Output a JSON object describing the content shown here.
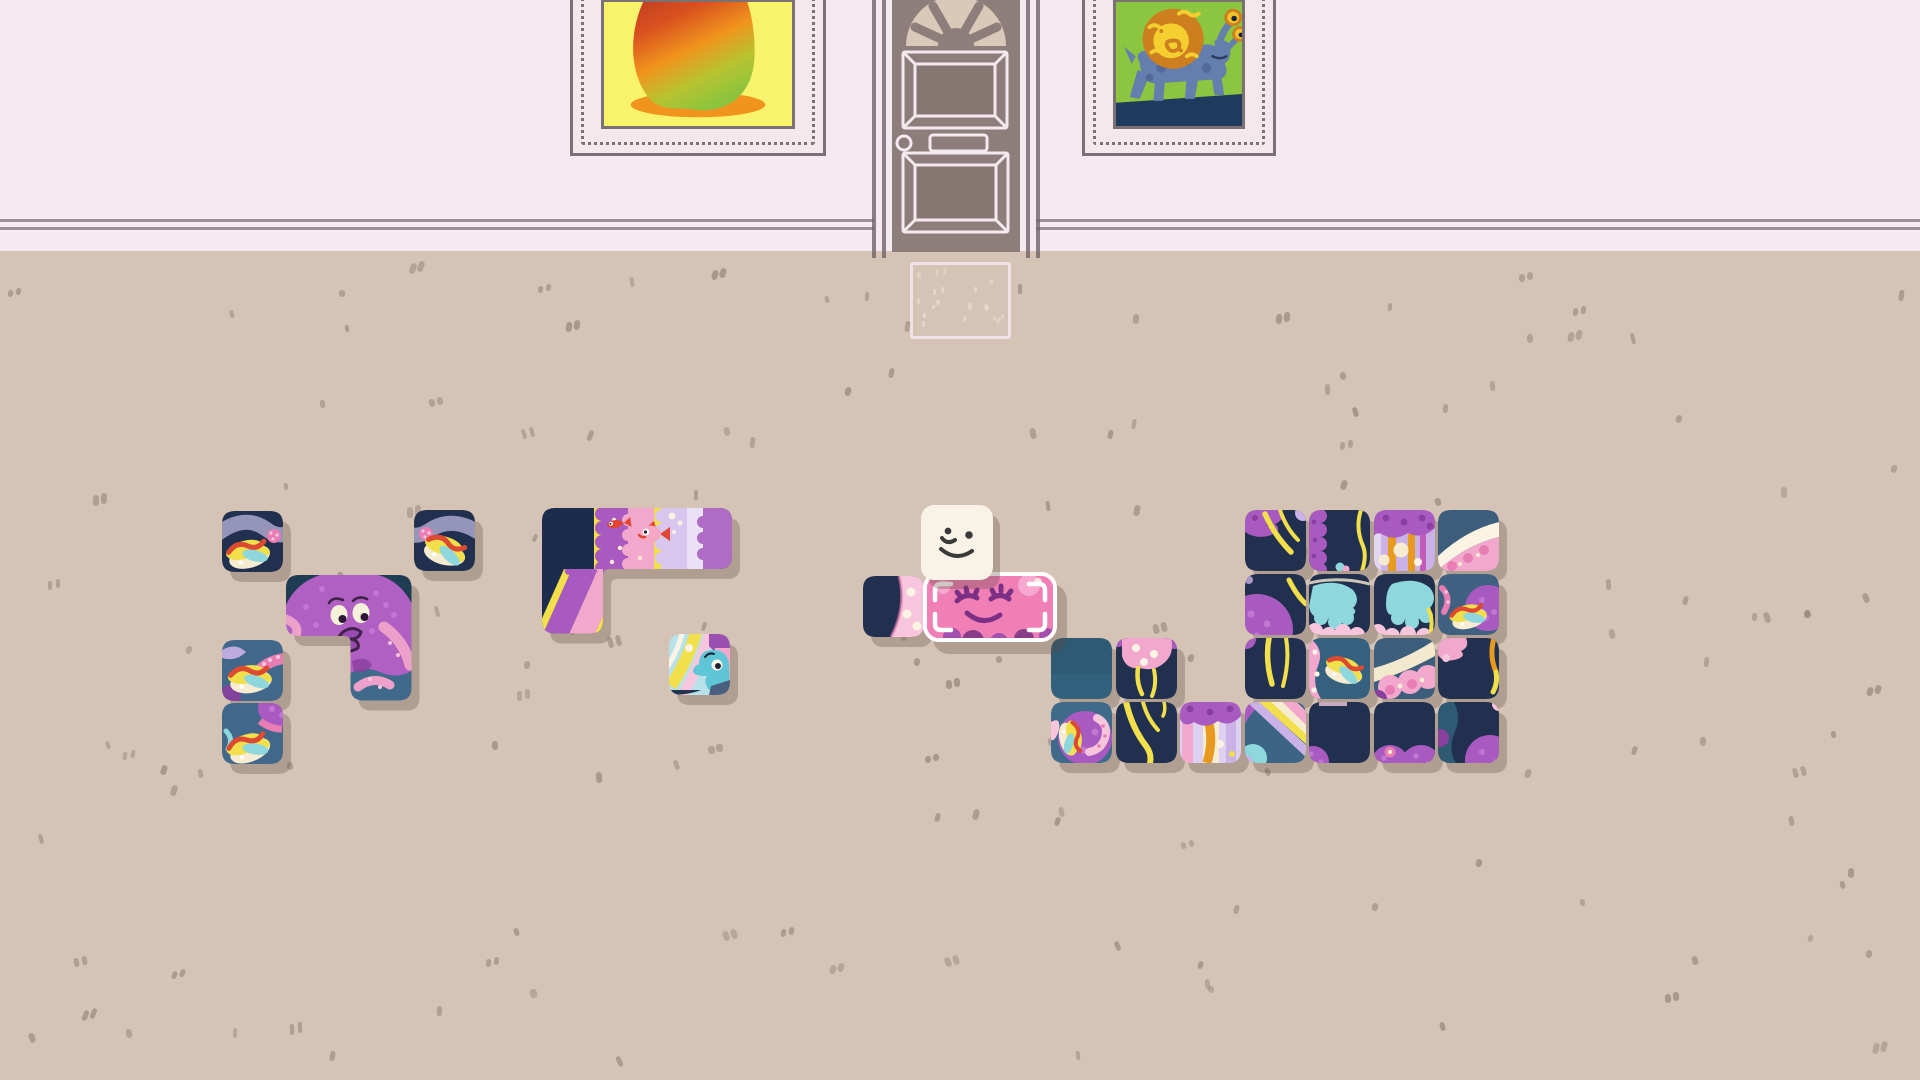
{
  "scene": {
    "name": "puzzle-room",
    "width": 1920,
    "height": 1080,
    "description": "top-down puzzle room: pink wall with door and two framed paintings, speckled tan floor, white square character assembling sea-creature jigsaw tiles"
  },
  "palette": {
    "wall": "#f5eaf2",
    "floor": "#d5c3b6",
    "speckle": "#8d7d74",
    "matLine": "#f0e5eb",
    "matSpeckle": "#ece2d4",
    "baseboard": "#8b8084",
    "shadow": "rgba(94,72,58,0.30)",
    "doorBody": "#8e7e7b",
    "doorPanel": "#877773",
    "doorLight": "#f3e9ef",
    "doorTrim": "#6f6468",
    "fanBg": "#dac8b8",
    "frame": "#7b7074",
    "frameMat": "#f3e8ec",
    "paintYellow": "#f9f26b",
    "mangoRed": "#a93226",
    "mangoOrange": "#f0941d",
    "mangoGreen": "#8ec43d",
    "paintGreen": "#8cc53f",
    "beastBlue": "#647fae",
    "beastBlueDark": "#54699b",
    "shellOrange": "#cd7f1f",
    "shellYellow": "#f5cf30",
    "groundNavy": "#1e3a5c",
    "eyeYellow": "#f2c12e",
    "pupil": "#15233f",
    "navy": "#22304f",
    "navyDeep": "#182743",
    "slate": "#3c5d7c",
    "slateLight": "#41688a",
    "teal": "#2e5a74",
    "purple": "#a85ac0",
    "purpleDark": "#8a3f9e",
    "purpleLight": "#c277d2",
    "lavender": "#cbb2e6",
    "lavenderLight": "#e2d6f2",
    "tentacle": "#a9a6cb",
    "pink": "#f2a8cc",
    "pinkLight": "#f7c6dd",
    "pinkDeep": "#e87db4",
    "cream": "#f6ecd1",
    "creamWhite": "#fbf4e4",
    "yellow": "#f1df4b",
    "orange": "#e8991f",
    "red": "#db4a31",
    "cyan": "#8ed7dd",
    "cyanDeep": "#5fc6d8",
    "wilmotBody": "#f8f3e6",
    "faceInk": "#3a3a3a",
    "heldPink": "#ef7fb5",
    "heldInk": "#7d2f86",
    "octoBody": "#b05fc2",
    "octoCorner": "#1e3d52",
    "octoSlate": "#3f6a8c",
    "octoPink": "#eda0ca",
    "eyeCream": "#f6f1d9",
    "octoInk": "#3f2349"
  },
  "wilmot": {
    "id": "wilmot-character",
    "x": 921,
    "y": 505,
    "w": 72,
    "h": 75
  },
  "held_piece": {
    "id": "piece-held-pink-face",
    "x": 923,
    "y": 572,
    "w": 126,
    "h": 62,
    "art": "pinkface"
  },
  "pieces": [
    {
      "id": "piece-jellyfish-1",
      "x": 222,
      "y": 511,
      "shape": "cell",
      "art": "hotdog1"
    },
    {
      "id": "piece-jellyfish-2",
      "x": 414,
      "y": 510,
      "shape": "cell",
      "art": "hotdog2"
    },
    {
      "id": "piece-octopus",
      "x": 286,
      "y": 575,
      "shape": "octoL",
      "art": "octopus"
    },
    {
      "id": "piece-jellyfish-3",
      "x": 222,
      "y": 640,
      "shape": "cell",
      "art": "hotdog3"
    },
    {
      "id": "piece-jellyfish-4",
      "x": 222,
      "y": 703,
      "shape": "cell",
      "art": "hotdog4"
    },
    {
      "id": "piece-reef-stripes",
      "x": 542,
      "y": 508,
      "shape": "reefL",
      "art": "reef"
    },
    {
      "id": "piece-seahorse",
      "x": 669,
      "y": 634,
      "shape": "cell",
      "art": "seahorse"
    },
    {
      "id": "piece-navy-wedge",
      "x": 863,
      "y": 576,
      "shape": "cell",
      "art": "wedge"
    },
    {
      "id": "piece-r0c3",
      "x": 1245,
      "y": 510,
      "shape": "cell",
      "art": "strandsTL"
    },
    {
      "id": "piece-r0c4",
      "x": 1309,
      "y": 510,
      "shape": "cell",
      "art": "scallopL"
    },
    {
      "id": "piece-r0c5",
      "x": 1374,
      "y": 510,
      "shape": "cell",
      "art": "jellyHead"
    },
    {
      "id": "piece-r0c6",
      "x": 1438,
      "y": 510,
      "shape": "cell",
      "art": "arcTR"
    },
    {
      "id": "piece-r1c3",
      "x": 1245,
      "y": 574,
      "shape": "cell",
      "art": "bellBL"
    },
    {
      "id": "piece-r1c4",
      "x": 1309,
      "y": 574,
      "shape": "cell",
      "art": "frillL"
    },
    {
      "id": "piece-r1c5",
      "x": 1374,
      "y": 574,
      "shape": "cell",
      "art": "frillR"
    },
    {
      "id": "piece-r1c6",
      "x": 1438,
      "y": 574,
      "shape": "cell",
      "art": "tealHotdogBell"
    },
    {
      "id": "piece-r2c0",
      "x": 1051,
      "y": 638,
      "shape": "cell",
      "art": "tealPlain"
    },
    {
      "id": "piece-r2c1",
      "x": 1116,
      "y": 638,
      "shape": "cell",
      "art": "pinkBellTop"
    },
    {
      "id": "piece-r2c3",
      "x": 1245,
      "y": 638,
      "shape": "cell",
      "art": "strandsV"
    },
    {
      "id": "piece-r2c4",
      "x": 1309,
      "y": 638,
      "shape": "cell",
      "art": "tealHotdogPink"
    },
    {
      "id": "piece-r2c5",
      "x": 1374,
      "y": 638,
      "shape": "cell",
      "art": "creamArc"
    },
    {
      "id": "piece-r2c6",
      "x": 1438,
      "y": 638,
      "shape": "cell",
      "art": "navyPinkCorner"
    },
    {
      "id": "piece-r3c0",
      "x": 1051,
      "y": 702,
      "shape": "cell",
      "art": "bellHotdog2"
    },
    {
      "id": "piece-r3c1",
      "x": 1116,
      "y": 702,
      "shape": "cell",
      "art": "strandsCurve"
    },
    {
      "id": "piece-r3c2",
      "x": 1180,
      "y": 702,
      "shape": "cell",
      "art": "mushroom"
    },
    {
      "id": "piece-r3c3",
      "x": 1245,
      "y": 702,
      "shape": "cell",
      "art": "rainbowDiag"
    },
    {
      "id": "piece-r3c4",
      "x": 1309,
      "y": 702,
      "shape": "cell",
      "art": "navyPurpleCorner"
    },
    {
      "id": "piece-r3c5",
      "x": 1374,
      "y": 702,
      "shape": "cell",
      "art": "navyTwoBells"
    },
    {
      "id": "piece-r3c6",
      "x": 1438,
      "y": 702,
      "shape": "cell",
      "art": "navyBellBR"
    }
  ],
  "floor_speckles": {
    "count": 150,
    "seed": 42,
    "area": [
      8,
      262,
      1904,
      808
    ]
  },
  "mat_speckles": {
    "count": 16,
    "seed": 7,
    "area": [
      916,
      268,
      84,
      58
    ]
  },
  "door": {
    "id": "front-door"
  },
  "paintings": {
    "left": {
      "id": "painting-mango"
    },
    "right": {
      "id": "painting-snail-beast"
    }
  },
  "doormat": {
    "id": "doormat"
  }
}
